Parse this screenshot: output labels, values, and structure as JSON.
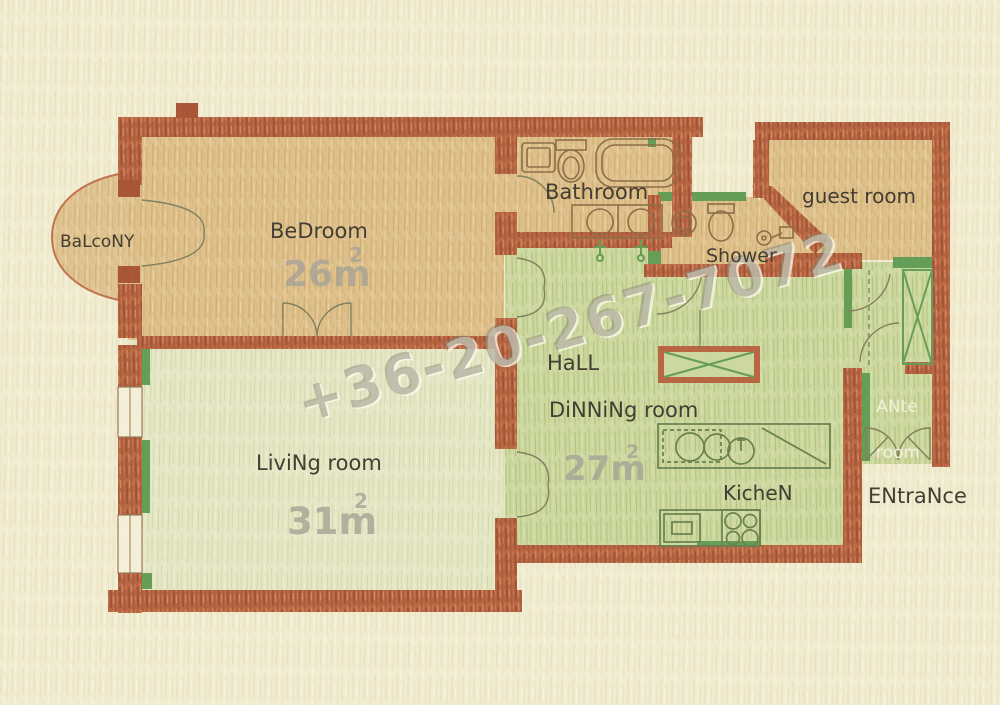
{
  "plan": {
    "title": "Apartment floor plan",
    "watermark": "+36-20-267-7072",
    "rooms": {
      "balcony": {
        "label": "BaLcoNY"
      },
      "bedroom": {
        "label": "BeDroom",
        "area": "26m",
        "area_sup": "2"
      },
      "bathroom": {
        "label": "Bathroom"
      },
      "shower": {
        "label": "Shower"
      },
      "guest": {
        "label": "guest room"
      },
      "hall": {
        "label": "HaLL"
      },
      "dining": {
        "label": "DiNNiNg room",
        "area": "27m",
        "area_sup": "2"
      },
      "kitchen": {
        "label": "KicheN"
      },
      "living": {
        "label": "LiviNg room",
        "area": "31m",
        "area_sup": "2"
      },
      "ante": {
        "line1": "ANte",
        "line2": "room"
      },
      "entrance": {
        "label": "ENtraNce"
      }
    },
    "colors": {
      "paper": "#f1ecd0",
      "wall": "#b0512c",
      "wall_dark_stub": "#9d3d20",
      "room_tan": "#dcba82",
      "room_green": "#c7d599",
      "room_pale_green": "#e3e5c3",
      "accent_dark_green": "#4e9143",
      "label_text": "#27211a",
      "area_text": "#9a988c",
      "ante_text": "#f4f1de",
      "watermark_text": "#76736 4"
    }
  }
}
